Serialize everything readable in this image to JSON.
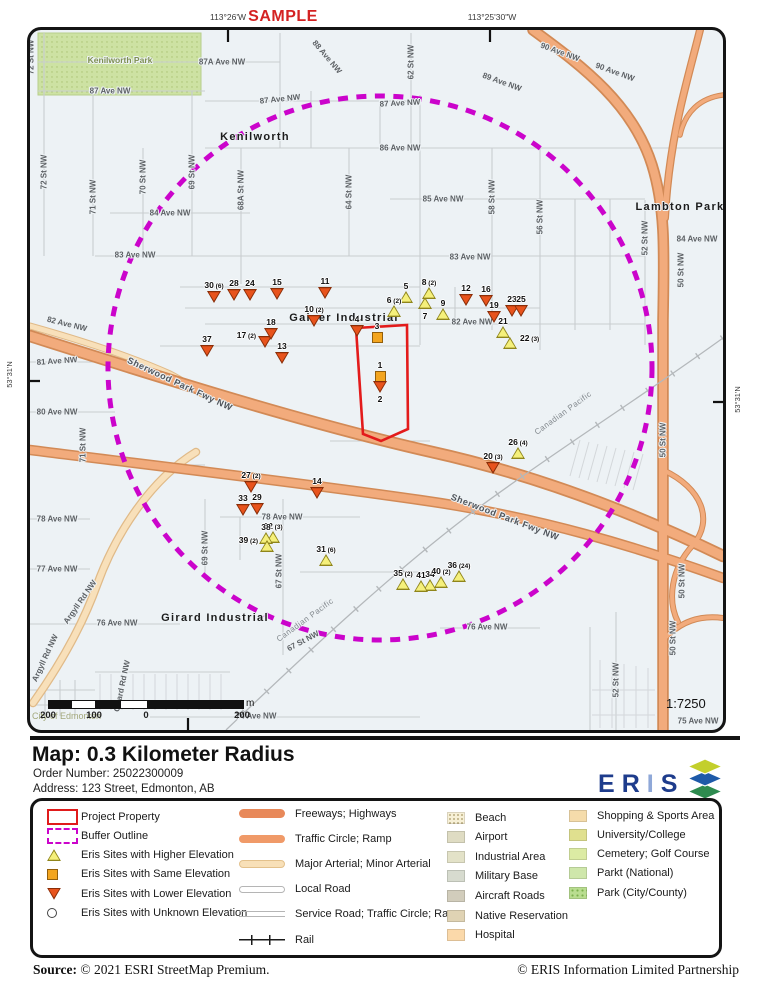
{
  "header": {
    "lon_left": "113°26'W",
    "sample": "SAMPLE",
    "lon_right": "113°25'30\"W"
  },
  "map": {
    "lat_left": "53°31'N",
    "lat_right": "53°31'N",
    "scale_ratio": "1:7250",
    "scale_unit": "m",
    "scale_labels": [
      "200",
      "100",
      "0",
      "200"
    ],
    "credit": "City of Edmonton",
    "buffer_color": "#cb04cb",
    "project_outline_color": "#e31b1b",
    "street_labels": [
      {
        "t": "72 St NW",
        "x": 31,
        "y": 57,
        "r": -90
      },
      {
        "t": "Kenilworth Park",
        "x": 120,
        "y": 60,
        "r": 0,
        "c": "park"
      },
      {
        "t": "87A Ave NW",
        "x": 222,
        "y": 62,
        "r": 0
      },
      {
        "t": "88 Ave NW",
        "x": 327,
        "y": 57,
        "r": 50
      },
      {
        "t": "62 St NW",
        "x": 411,
        "y": 62,
        "r": -90
      },
      {
        "t": "89 Ave NW",
        "x": 502,
        "y": 82,
        "r": 20
      },
      {
        "t": "90 Ave NW",
        "x": 560,
        "y": 52,
        "r": 20
      },
      {
        "t": "90 Ave NW",
        "x": 615,
        "y": 72,
        "r": 20
      },
      {
        "t": "87 Ave NW",
        "x": 110,
        "y": 91,
        "r": 0
      },
      {
        "t": "87 Ave NW",
        "x": 280,
        "y": 99,
        "r": -6
      },
      {
        "t": "87 Ave NW",
        "x": 400,
        "y": 103,
        "r": -3
      },
      {
        "t": "Kenilworth",
        "x": 255,
        "y": 137,
        "r": 0,
        "c": "area"
      },
      {
        "t": "86 Ave NW",
        "x": 400,
        "y": 148,
        "r": 0
      },
      {
        "t": "72 St NW",
        "x": 44,
        "y": 172,
        "r": -90
      },
      {
        "t": "71 St NW",
        "x": 93,
        "y": 197,
        "r": -90
      },
      {
        "t": "70 St NW",
        "x": 143,
        "y": 177,
        "r": -90
      },
      {
        "t": "69 St NW",
        "x": 192,
        "y": 172,
        "r": -90
      },
      {
        "t": "68A St NW",
        "x": 241,
        "y": 190,
        "r": -90
      },
      {
        "t": "64 St NW",
        "x": 349,
        "y": 192,
        "r": -90
      },
      {
        "t": "85 Ave NW",
        "x": 443,
        "y": 199,
        "r": 0
      },
      {
        "t": "58 St NW",
        "x": 492,
        "y": 197,
        "r": -90
      },
      {
        "t": "56 St NW",
        "x": 540,
        "y": 217,
        "r": -90
      },
      {
        "t": "Lambton Park",
        "x": 680,
        "y": 207,
        "r": 0,
        "c": "area"
      },
      {
        "t": "84 Ave NW",
        "x": 170,
        "y": 213,
        "r": 0
      },
      {
        "t": "84 Ave NW",
        "x": 697,
        "y": 239,
        "r": 0
      },
      {
        "t": "52 St NW",
        "x": 645,
        "y": 238,
        "r": -90
      },
      {
        "t": "50 St NW",
        "x": 681,
        "y": 270,
        "r": -90
      },
      {
        "t": "83 Ave NW",
        "x": 135,
        "y": 255,
        "r": 0
      },
      {
        "t": "83 Ave NW",
        "x": 470,
        "y": 257,
        "r": 0
      },
      {
        "t": "82 Ave NW",
        "x": 67,
        "y": 324,
        "r": 14
      },
      {
        "t": "82 Ave NW",
        "x": 472,
        "y": 322,
        "r": 0
      },
      {
        "t": "Gainer Industrial",
        "x": 344,
        "y": 318,
        "r": 0,
        "c": "area"
      },
      {
        "t": "81 Ave NW",
        "x": 57,
        "y": 361,
        "r": -4
      },
      {
        "t": "Sherwood Park Fwy NW",
        "x": 180,
        "y": 384,
        "r": 25,
        "c": "fwy"
      },
      {
        "t": "80 Ave NW",
        "x": 57,
        "y": 412,
        "r": 0
      },
      {
        "t": "71 St NW",
        "x": 83,
        "y": 445,
        "r": -90
      },
      {
        "t": "50 St NW",
        "x": 663,
        "y": 440,
        "r": -90
      },
      {
        "t": "Canadian Pacific",
        "x": 563,
        "y": 413,
        "r": -36,
        "c": "rail"
      },
      {
        "t": "Sherwood Park Fwy NW",
        "x": 505,
        "y": 517,
        "r": 21,
        "c": "fwy"
      },
      {
        "t": "78 Ave NW",
        "x": 57,
        "y": 519,
        "r": 0
      },
      {
        "t": "78 Ave NW",
        "x": 282,
        "y": 517,
        "r": 0
      },
      {
        "t": "77 Ave NW",
        "x": 57,
        "y": 569,
        "r": 0
      },
      {
        "t": "69 St NW",
        "x": 205,
        "y": 548,
        "r": -90
      },
      {
        "t": "67 St NW",
        "x": 279,
        "y": 571,
        "r": -90
      },
      {
        "t": "76 Ave NW",
        "x": 117,
        "y": 623,
        "r": 0
      },
      {
        "t": "76 Ave NW",
        "x": 487,
        "y": 627,
        "r": 0
      },
      {
        "t": "Girard Industrial",
        "x": 215,
        "y": 618,
        "r": 0,
        "c": "area"
      },
      {
        "t": "Argyll Rd NW",
        "x": 80,
        "y": 602,
        "r": -55
      },
      {
        "t": "Argyll Rd NW",
        "x": 45,
        "y": 658,
        "r": -65
      },
      {
        "t": "Girard Rd NW",
        "x": 122,
        "y": 686,
        "r": -78
      },
      {
        "t": "Canadian Pacific",
        "x": 305,
        "y": 620,
        "r": -36,
        "c": "rail"
      },
      {
        "t": "67 St NW",
        "x": 303,
        "y": 641,
        "r": -28
      },
      {
        "t": "74 Ave NW",
        "x": 256,
        "y": 716,
        "r": 0
      },
      {
        "t": "75 Ave NW",
        "x": 698,
        "y": 721,
        "r": 0
      },
      {
        "t": "52 St NW",
        "x": 616,
        "y": 680,
        "r": -90
      },
      {
        "t": "50 St NW",
        "x": 682,
        "y": 581,
        "r": -90
      },
      {
        "t": "50 St NW",
        "x": 673,
        "y": 638,
        "r": -90
      }
    ],
    "markers": [
      {
        "n": "1",
        "t": "S",
        "x": 380,
        "y": 376
      },
      {
        "n": "2",
        "t": "L",
        "x": 380,
        "y": 386,
        "lp": "below"
      },
      {
        "n": "3",
        "t": "S",
        "x": 377,
        "y": 337
      },
      {
        "n": "4",
        "t": "L",
        "x": 357,
        "y": 330
      },
      {
        "n": "5",
        "t": "H",
        "x": 406,
        "y": 297
      },
      {
        "n": "6",
        "s": "(2)",
        "t": "H",
        "x": 394,
        "y": 311
      },
      {
        "n": "7",
        "t": "H",
        "x": 425,
        "y": 303,
        "lp": "below"
      },
      {
        "n": "8",
        "s": "(2)",
        "t": "H",
        "x": 429,
        "y": 293
      },
      {
        "n": "9",
        "t": "H",
        "x": 443,
        "y": 314
      },
      {
        "n": "10",
        "s": "(2)",
        "t": "L",
        "x": 314,
        "y": 320
      },
      {
        "n": "11",
        "t": "L",
        "x": 325,
        "y": 292
      },
      {
        "n": "12",
        "t": "L",
        "x": 466,
        "y": 299
      },
      {
        "n": "13",
        "t": "L",
        "x": 282,
        "y": 357
      },
      {
        "n": "14",
        "t": "L",
        "x": 317,
        "y": 492
      },
      {
        "n": "15",
        "t": "L",
        "x": 277,
        "y": 293
      },
      {
        "n": "16",
        "t": "L",
        "x": 486,
        "y": 300
      },
      {
        "n": "17",
        "s": "(2)",
        "t": "L",
        "x": 265,
        "y": 341,
        "lp": "left"
      },
      {
        "n": "18",
        "t": "L",
        "x": 271,
        "y": 333
      },
      {
        "n": "19",
        "t": "L",
        "x": 494,
        "y": 316
      },
      {
        "n": "20",
        "s": "(3)",
        "t": "L",
        "x": 493,
        "y": 467
      },
      {
        "n": "21",
        "t": "H",
        "x": 503,
        "y": 332
      },
      {
        "n": "22",
        "s": "(3)",
        "t": "H",
        "x": 510,
        "y": 343,
        "lp": "right"
      },
      {
        "n": "23",
        "t": "L",
        "x": 512,
        "y": 310
      },
      {
        "n": "24",
        "t": "L",
        "x": 250,
        "y": 294
      },
      {
        "n": "25",
        "t": "L",
        "x": 521,
        "y": 310
      },
      {
        "n": "26",
        "s": "(4)",
        "t": "H",
        "x": 518,
        "y": 453
      },
      {
        "n": "27",
        "s": "(2)",
        "t": "L",
        "x": 251,
        "y": 486
      },
      {
        "n": "28",
        "t": "L",
        "x": 234,
        "y": 294
      },
      {
        "n": "29",
        "t": "L",
        "x": 257,
        "y": 508
      },
      {
        "n": "30",
        "s": "(6)",
        "t": "L",
        "x": 214,
        "y": 296
      },
      {
        "n": "31",
        "s": "(6)",
        "t": "H",
        "x": 326,
        "y": 560
      },
      {
        "n": "32",
        "s": "(3)",
        "t": "H",
        "x": 273,
        "y": 537
      },
      {
        "n": "33",
        "t": "L",
        "x": 243,
        "y": 509
      },
      {
        "n": "34",
        "t": "H",
        "x": 430,
        "y": 585
      },
      {
        "n": "35",
        "s": "(2)",
        "t": "H",
        "x": 403,
        "y": 584
      },
      {
        "n": "36",
        "s": "(24)",
        "t": "H",
        "x": 459,
        "y": 576
      },
      {
        "n": "37",
        "t": "L",
        "x": 207,
        "y": 350
      },
      {
        "n": "38",
        "t": "H",
        "x": 266,
        "y": 538
      },
      {
        "n": "39",
        "s": "(2)",
        "t": "H",
        "x": 267,
        "y": 546,
        "lp": "left"
      },
      {
        "n": "40",
        "s": "(2)",
        "t": "H",
        "x": 441,
        "y": 582
      },
      {
        "n": "41",
        "t": "H",
        "x": 421,
        "y": 586
      }
    ]
  },
  "title_block": {
    "title": "Map: 0.3 Kilometer Radius",
    "order_number": "Order Number: 25022300009",
    "address": "Address: 123 Street, Edmonton, AB",
    "logo_e": "E",
    "logo_r": "R",
    "logo_i": "I",
    "logo_s": "S"
  },
  "legend": {
    "sites": [
      {
        "label": "Project Property",
        "type": "project"
      },
      {
        "label": "Buffer Outline",
        "type": "buffer"
      },
      {
        "label": "Eris Sites with Higher Elevation",
        "type": "higher"
      },
      {
        "label": "Eris Sites with Same Elevation",
        "type": "same"
      },
      {
        "label": "Eris Sites with Lower Elevation",
        "type": "lower"
      },
      {
        "label": "Eris Sites with Unknown Elevation",
        "type": "unknown"
      }
    ],
    "roads": [
      {
        "label": "Freeways; Highways",
        "type": "freeway"
      },
      {
        "label": "Traffic Circle; Ramp",
        "type": "ramp"
      },
      {
        "label": "Major Arterial; Minor Arterial",
        "type": "arterial"
      },
      {
        "label": "Local Road",
        "type": "local"
      },
      {
        "label": "Service Road; Traffic Circle; Ramp",
        "type": "service"
      },
      {
        "label": "Rail",
        "type": "rail"
      }
    ],
    "areas_col1": [
      {
        "label": "Beach",
        "color": "#f7f0d6",
        "pattern": "dots-tan"
      },
      {
        "label": "Airport",
        "color": "#dfdcc3"
      },
      {
        "label": "Industrial Area",
        "color": "#e3e2c8"
      },
      {
        "label": "Military Base",
        "color": "#d7dbcf"
      },
      {
        "label": "Aircraft Roads",
        "color": "#d2cdbc"
      },
      {
        "label": "Native Reservation",
        "color": "#e0d3b4"
      },
      {
        "label": "Hospital",
        "color": "#fbd9aa"
      }
    ],
    "areas_col2": [
      {
        "label": "Shopping & Sports Area",
        "color": "#f5dcab"
      },
      {
        "label": "University/College",
        "color": "#e0e08f"
      },
      {
        "label": "Cemetery; Golf Course",
        "color": "#dceba4"
      },
      {
        "label": "Parkt (National)",
        "color": "#cfe7ab"
      },
      {
        "label": "Park (City/County)",
        "color": "#b9dd90",
        "pattern": "dots-green"
      }
    ]
  },
  "footer": {
    "source_label": "Source:",
    "source_text": "© 2021 ESRI StreetMap Premium.",
    "copyright": "© ERIS Information Limited Partnership"
  }
}
